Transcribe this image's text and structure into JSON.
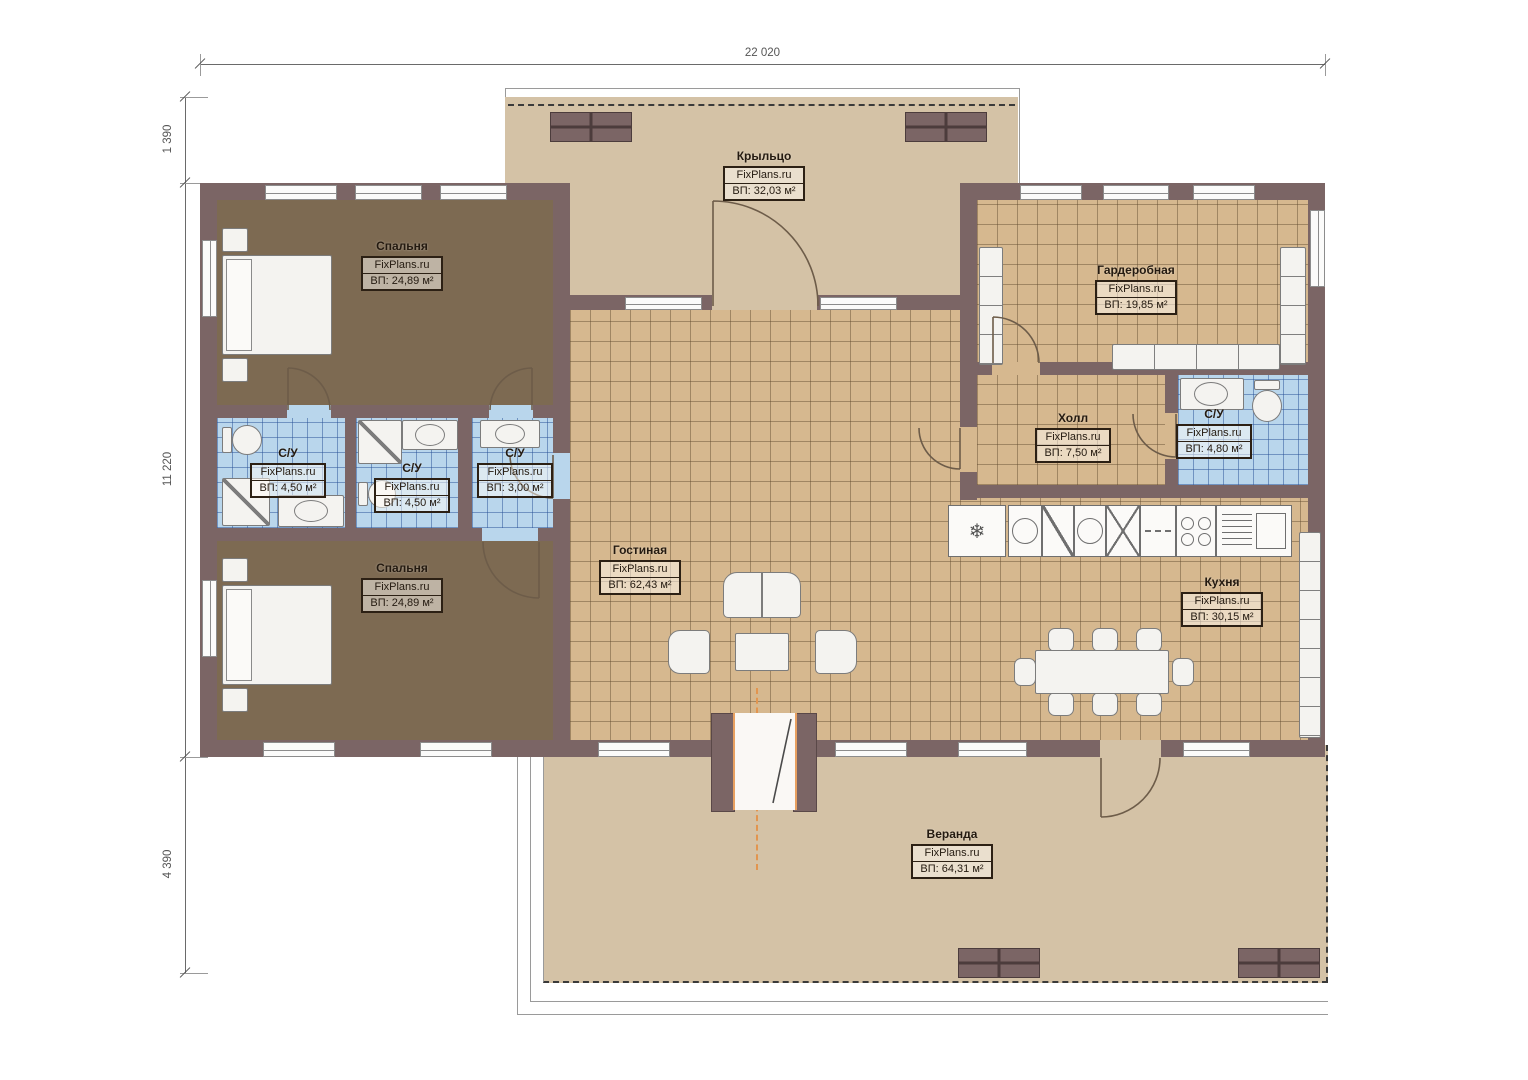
{
  "meta": {
    "brand": "FixPlans.ru",
    "drawing_type": "floor plan"
  },
  "dimensions": {
    "top_width": "22 020",
    "left_top": "1 390",
    "left_middle": "11 220",
    "left_bottom": "4 390"
  },
  "rooms": [
    {
      "name": "Крыльцо",
      "brand": "FixPlans.ru",
      "area": "ВП: 32,03 м²"
    },
    {
      "name": "Спальня",
      "brand": "FixPlans.ru",
      "area": "ВП: 24,89 м²"
    },
    {
      "name": "Гардеробная",
      "brand": "FixPlans.ru",
      "area": "ВП: 19,85 м²"
    },
    {
      "name": "Холл",
      "brand": "FixPlans.ru",
      "area": "ВП: 7,50 м²"
    },
    {
      "name": "С/У",
      "brand": "FixPlans.ru",
      "area": "ВП: 4,80 м²"
    },
    {
      "name": "С/У",
      "brand": "FixPlans.ru",
      "area": "ВП: 4,50 м²"
    },
    {
      "name": "С/У",
      "brand": "FixPlans.ru",
      "area": "ВП: 4,50 м²"
    },
    {
      "name": "С/У",
      "brand": "FixPlans.ru",
      "area": "ВП: 3,00 м²"
    },
    {
      "name": "Гостиная",
      "brand": "FixPlans.ru",
      "area": "ВП: 62,43 м²"
    },
    {
      "name": "Спальня",
      "brand": "FixPlans.ru",
      "area": "ВП: 24,89 м²"
    },
    {
      "name": "Кухня",
      "brand": "FixPlans.ru",
      "area": "ВП: 30,15 м²"
    },
    {
      "name": "Веранда",
      "brand": "FixPlans.ru",
      "area": "ВП: 64,31 м²"
    }
  ],
  "icons": {
    "fridge": "❄"
  },
  "colors": {
    "wall": "#7b6565",
    "bedroom_floor": "#7d6a52",
    "tile_floor": "#d6b88f",
    "bathroom_floor": "#b9d6ec",
    "porch_veranda_floor": "#d4c2a6",
    "door_accent": "#e2954f",
    "dimension_text": "#555555"
  }
}
